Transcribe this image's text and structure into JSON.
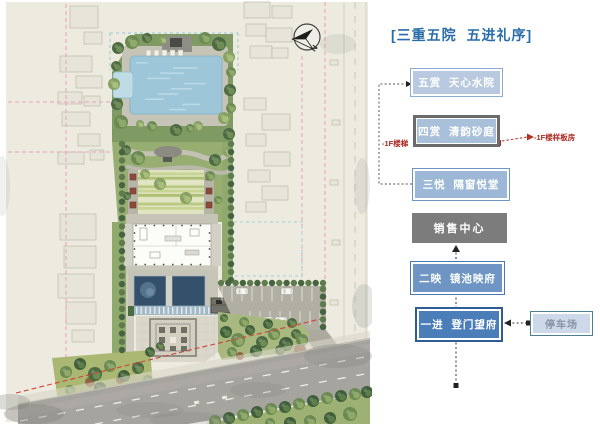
{
  "page": {
    "title": "[三重五院  五进礼序]"
  },
  "flow": {
    "boxes": [
      {
        "id": "five-view-water-court",
        "label": "五赏  天心水院"
      },
      {
        "id": "four-view-sand-court",
        "label": "四赏  清韵砂庭"
      },
      {
        "id": "three-joy-window-hall",
        "label": "三悦  隔窗悦堂"
      },
      {
        "id": "sales-center",
        "label": "销售中心"
      },
      {
        "id": "two-reflection-mirror-pool",
        "label": "二映  镜池映府"
      },
      {
        "id": "one-entry-gate",
        "label": "一进  登门望府"
      },
      {
        "id": "parking-lot",
        "label": "停车场"
      }
    ],
    "annotations": {
      "basement_stair": "-1F楼梯",
      "basement_showroom": "-1F楼样板房"
    }
  },
  "siteplan": {
    "compass_label": "N"
  },
  "colors": {
    "accent-blue": "#2a6cab",
    "annotation-red": "#a8281e",
    "box1-fill": "#b9c9e0",
    "box1-edge": "#8fadd0",
    "box2-fill": "#a9c0db",
    "box2-edge": "#6b6b6b",
    "box2-dot": "#b02a20",
    "box3-fill": "#9db8d6",
    "box3-edge": "#6f97c4",
    "box4-fill": "#7c7c7c",
    "box5-fill": "#6e95c4",
    "box5-edge": "#4a79b2",
    "box6-fill": "#4b7db8",
    "box6-edge": "#2e5d96",
    "box7-fill": "#cdd9e9",
    "box7-edge": "#4d7f8e",
    "box7-text": "#8695a6"
  }
}
